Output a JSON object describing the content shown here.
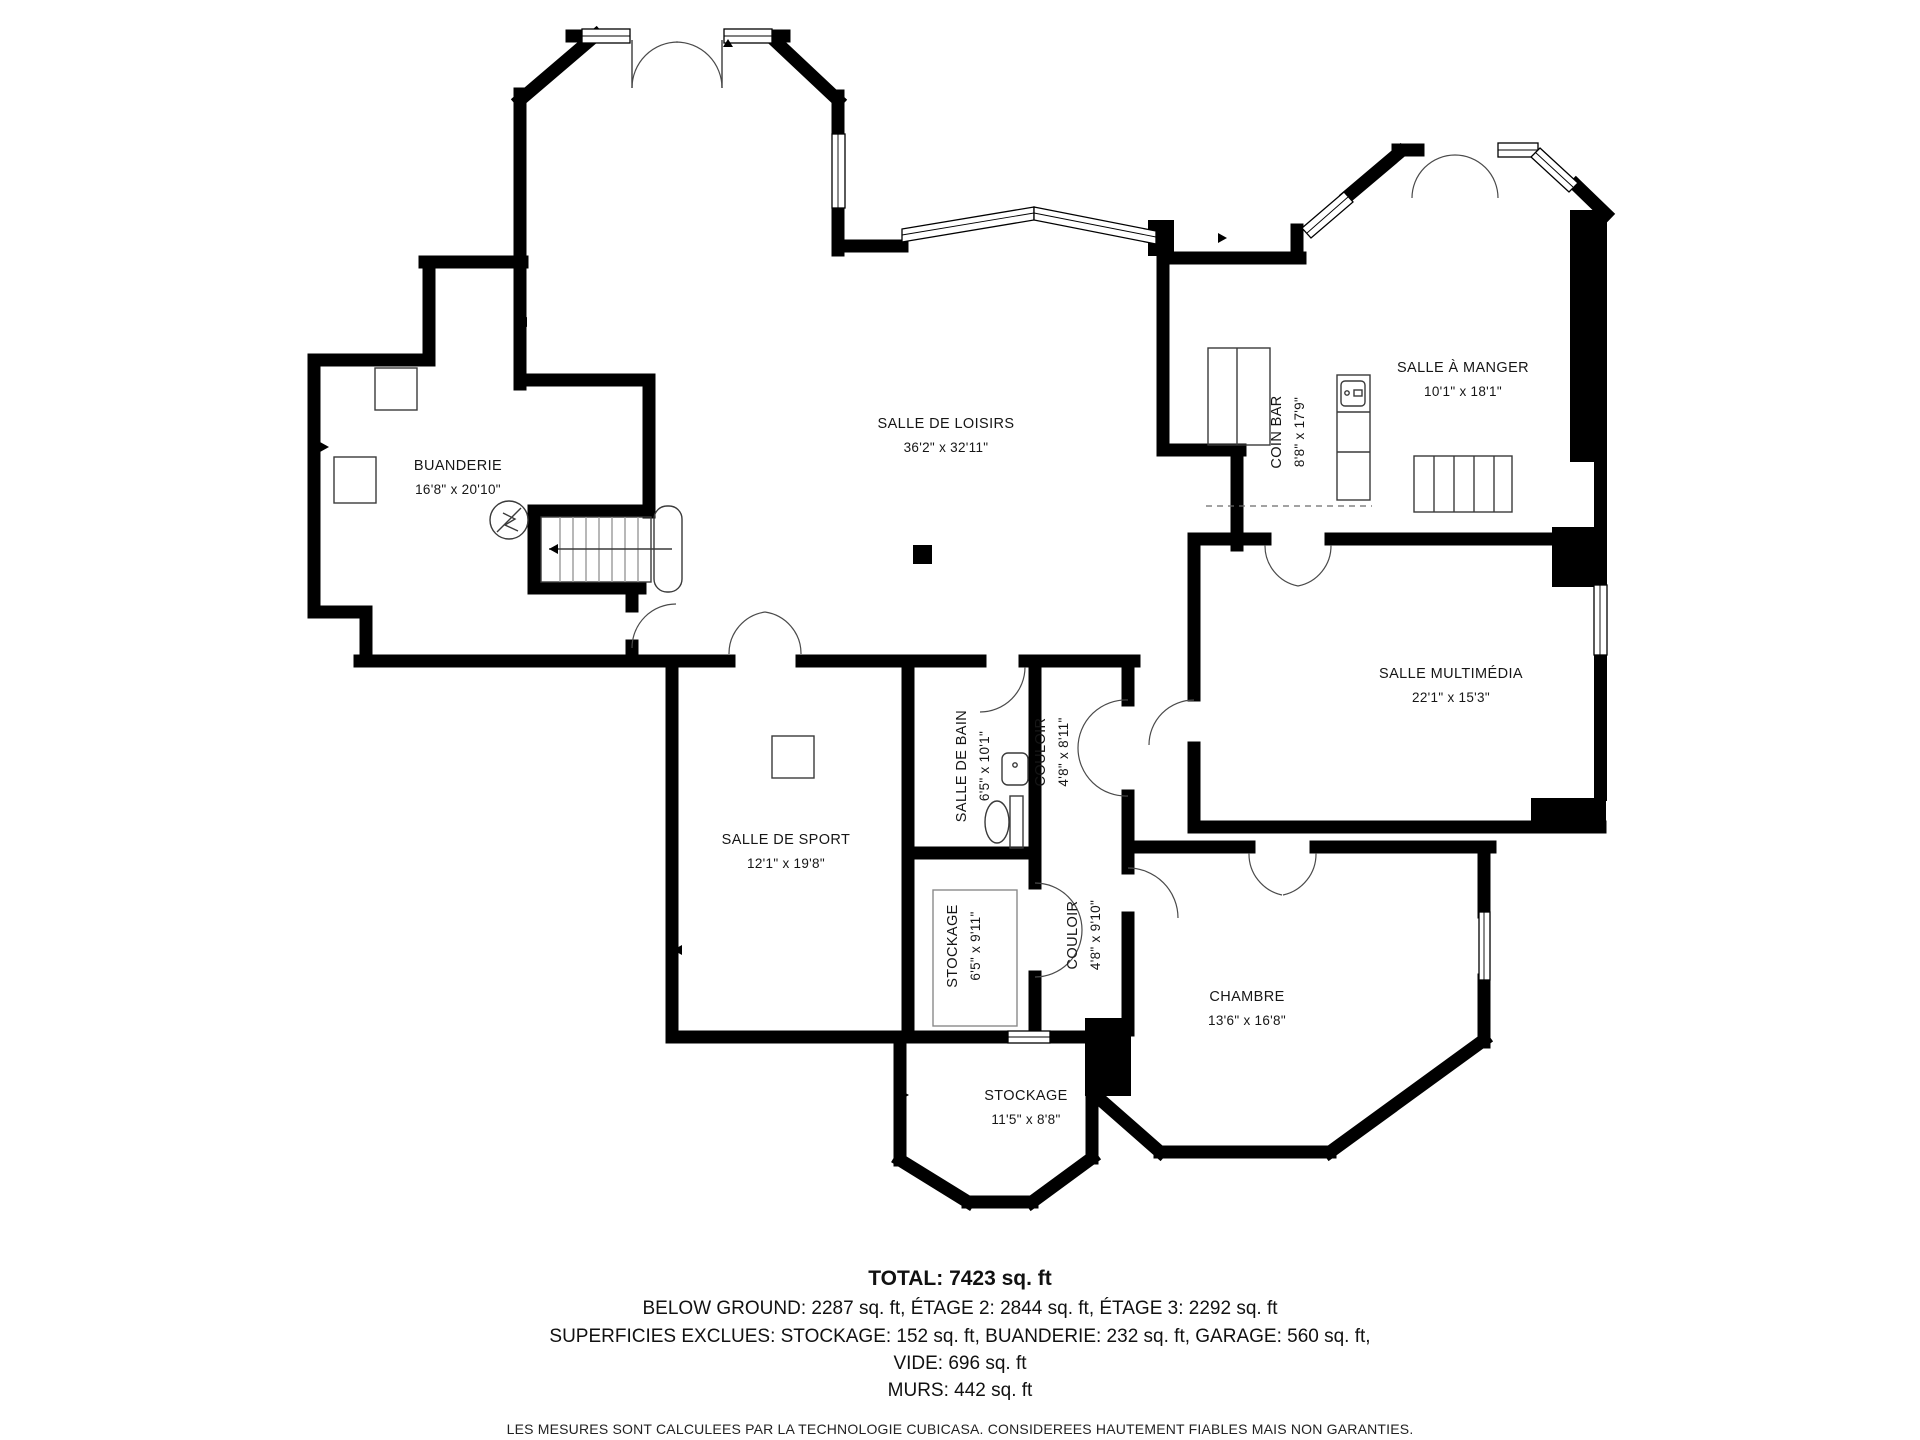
{
  "rooms": [
    {
      "id": "salle-de-loisirs",
      "label": "SALLE DE LOISIRS",
      "dims": "36'2\" x 32'11\""
    },
    {
      "id": "buanderie",
      "label": "BUANDERIE",
      "dims": "16'8\" x 20'10\""
    },
    {
      "id": "coin-bar",
      "label": "COIN BAR",
      "dims": "8'8\" x 17'9\""
    },
    {
      "id": "salle-a-manger",
      "label": "SALLE À MANGER",
      "dims": "10'1\" x 18'1\""
    },
    {
      "id": "salle-multimedia",
      "label": "SALLE MULTIMÉDIA",
      "dims": "22'1\" x 15'3\""
    },
    {
      "id": "salle-de-bain",
      "label": "SALLE DE BAIN",
      "dims": "6'5\" x 10'1\""
    },
    {
      "id": "couloir-haut",
      "label": "COULOIR",
      "dims": "4'8\" x 8'11\""
    },
    {
      "id": "salle-de-sport",
      "label": "SALLE DE SPORT",
      "dims": "12'1\" x 19'8\""
    },
    {
      "id": "stockage-milieu",
      "label": "STOCKAGE",
      "dims": "6'5\" x 9'11\""
    },
    {
      "id": "couloir-bas",
      "label": "COULOIR",
      "dims": "4'8\" x 9'10\""
    },
    {
      "id": "chambre",
      "label": "CHAMBRE",
      "dims": "13'6\" x 16'8\""
    },
    {
      "id": "stockage-bas",
      "label": "STOCKAGE",
      "dims": "11'5\" x 8'8\""
    }
  ],
  "summary": {
    "total": "TOTAL: 7423 sq. ft",
    "floors": "BELOW GROUND: 2287 sq. ft, ÉTAGE 2: 2844 sq. ft, ÉTAGE 3: 2292 sq. ft",
    "excluded": "SUPERFICIES EXCLUES: STOCKAGE: 152 sq. ft, BUANDERIE: 232 sq. ft, GARAGE: 560 sq. ft,",
    "vide": "VIDE: 696 sq. ft",
    "murs": "MURS: 442 sq. ft"
  },
  "disclaimer": "LES MESURES SONT CALCULEES PAR LA TECHNOLOGIE CUBICASA. CONSIDEREES HAUTEMENT FIABLES MAIS NON GARANTIES."
}
